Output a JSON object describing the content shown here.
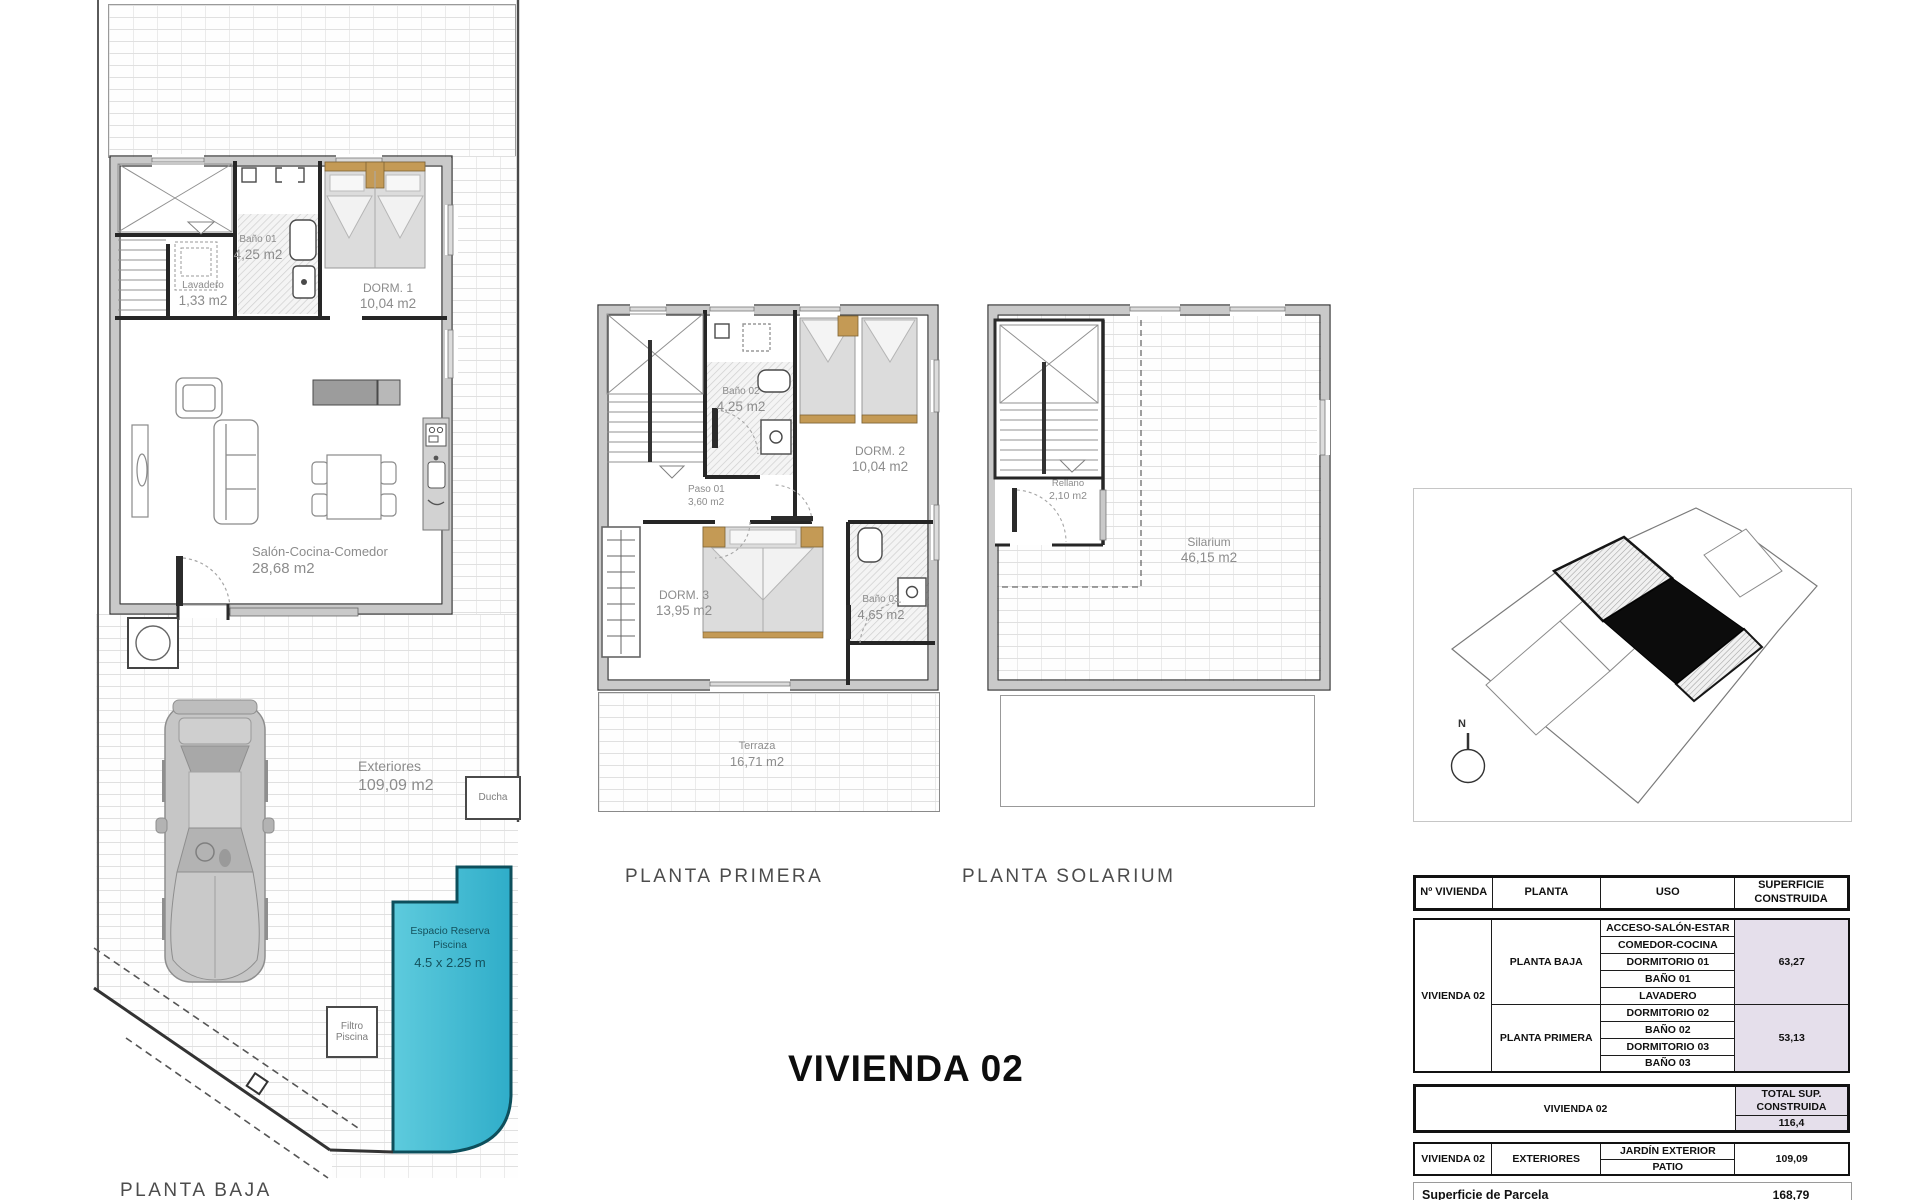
{
  "title": "VIVIENDA 02",
  "plans": {
    "baja": {
      "label": "PLANTA BAJA",
      "rooms": {
        "lavadero": {
          "name": "Lavadero",
          "area": "1,33 m2"
        },
        "bano01": {
          "name": "Baño 01",
          "area": "4,25 m2"
        },
        "dorm1": {
          "name": "DORM. 1",
          "area": "10,04 m2"
        },
        "salon": {
          "name": "Salón-Cocina-Comedor",
          "area": "28,68 m2"
        },
        "exteriores": {
          "name": "Exteriores",
          "area": "109,09 m2"
        },
        "ducha": {
          "name": "Ducha"
        },
        "piscina": {
          "line1": "Espacio Reserva",
          "line2": "Piscina",
          "line3": "4.5 x 2.25 m"
        },
        "filtro": {
          "line1": "Filtro",
          "line2": "Piscina"
        }
      }
    },
    "primera": {
      "label": "PLANTA PRIMERA",
      "rooms": {
        "bano02": {
          "name": "Baño 02",
          "area": "4,25 m2"
        },
        "dorm2": {
          "name": "DORM. 2",
          "area": "10,04 m2"
        },
        "paso": {
          "name": "Paso 01",
          "area": "3,60 m2"
        },
        "dorm3": {
          "name": "DORM. 3",
          "area": "13,95 m2"
        },
        "bano03": {
          "name": "Baño 03",
          "area": "4,65 m2"
        },
        "terraza": {
          "name": "Terraza",
          "area": "16,71 m2"
        }
      }
    },
    "solarium": {
      "label": "PLANTA SOLARIUM",
      "rooms": {
        "rellano": {
          "name": "Rellano",
          "area": "2,10 m2"
        },
        "silarium": {
          "name": "Silarium",
          "area": "46,15 m2"
        }
      }
    }
  },
  "site_map": {
    "north": "N"
  },
  "table": {
    "headers": {
      "col1": "Nº VIVIENDA",
      "col2": "PLANTA",
      "col3": "USO",
      "col4a": "SUPERFICIE",
      "col4b": "CONSTRUIDA"
    },
    "vivienda": "VIVIENDA 02",
    "baja": {
      "label": "PLANTA BAJA",
      "uses": [
        "ACCESO-SALÓN-ESTAR",
        "COMEDOR-COCINA",
        "DORMITORIO 01",
        "BAÑO 01",
        "LAVADERO"
      ],
      "superficie": "63,27"
    },
    "primera": {
      "label": "PLANTA PRIMERA",
      "uses": [
        "DORMITORIO 02",
        "BAÑO 02",
        "DORMITORIO 03",
        "BAÑO 03"
      ],
      "superficie": "53,13"
    },
    "total": {
      "vivienda": "VIVIENDA 02",
      "label1": "TOTAL SUP.",
      "label2": "CONSTRUIDA",
      "value": "116,4"
    },
    "exteriores": {
      "vivienda": "VIVIENDA 02",
      "label": "EXTERIORES",
      "uses": [
        "JARDÍN EXTERIOR",
        "PATIO"
      ],
      "superficie": "109,09"
    },
    "parcela": {
      "label": "Superficie de Parcela",
      "value": "168,79"
    }
  },
  "colors": {
    "pool": "#49c0d8",
    "shade": "#e5dfeb",
    "wood": "#c49a55"
  }
}
